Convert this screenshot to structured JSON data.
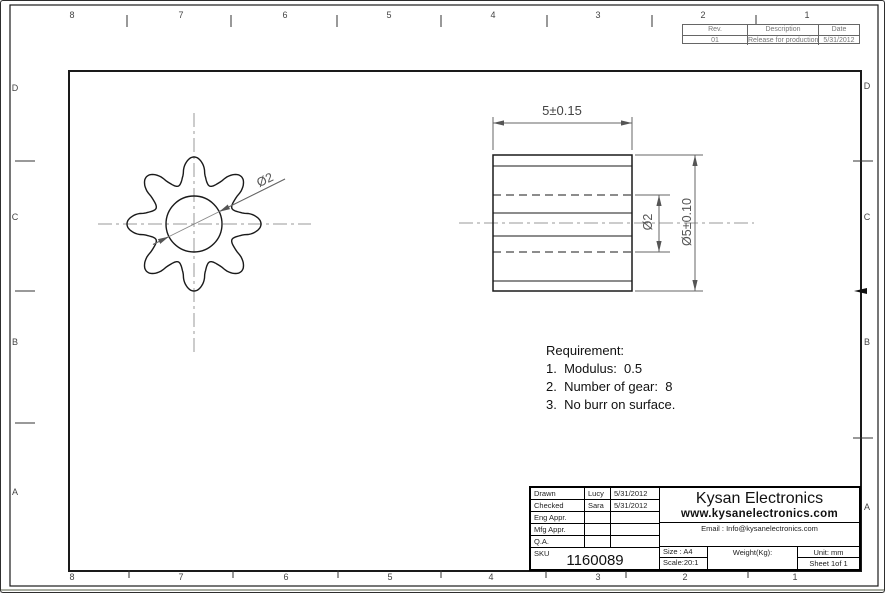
{
  "sheet": {
    "zones_top": [
      "8",
      "7",
      "6",
      "5",
      "4",
      "3",
      "2",
      "1"
    ],
    "zones_bottom": [
      "8",
      "7",
      "6",
      "5",
      "4",
      "3",
      "2",
      "1"
    ],
    "zones_left": [
      "D",
      "C",
      "B",
      "A"
    ],
    "zones_right": [
      "D",
      "C",
      "B",
      "A"
    ]
  },
  "revision_table": {
    "col_rev": "Rev.",
    "col_description": "Description",
    "col_date": "Date",
    "row_rev": "01",
    "row_description": "Release for production",
    "row_date": "5/31/2012"
  },
  "front_view": {
    "hole_dim": "Ø2"
  },
  "side_view": {
    "width_dim": "5±0.15",
    "outer_dia_dim": "Ø5±0.10",
    "hole_dim": "Ø2"
  },
  "requirements": {
    "title": "Requirement:",
    "item1": "1.  Modulus:  0.5",
    "item2": "2.  Number of gear:  8",
    "item3": "3.  No burr on surface."
  },
  "title_block": {
    "drawn_label": "Drawn",
    "drawn_name": "Lucy",
    "drawn_date": "5/31/2012",
    "checked_label": "Checked",
    "checked_name": "Sara",
    "checked_date": "5/31/2012",
    "eng_appr_label": "Eng Appr.",
    "mfg_appr_label": "Mfg Appr.",
    "qa_label": "Q.A.",
    "sku_label": "SKU",
    "sku_value": "1160089",
    "company": "Kysan Electronics",
    "website": "www.kysanelectronics.com",
    "email": "Email : Info@kysanelectronics.com",
    "size": "Size : A4",
    "scale": "Scale:20:1",
    "weight": "Weight(Kg):",
    "unit": "Unit: mm",
    "sheet": "Sheet 1of 1"
  }
}
